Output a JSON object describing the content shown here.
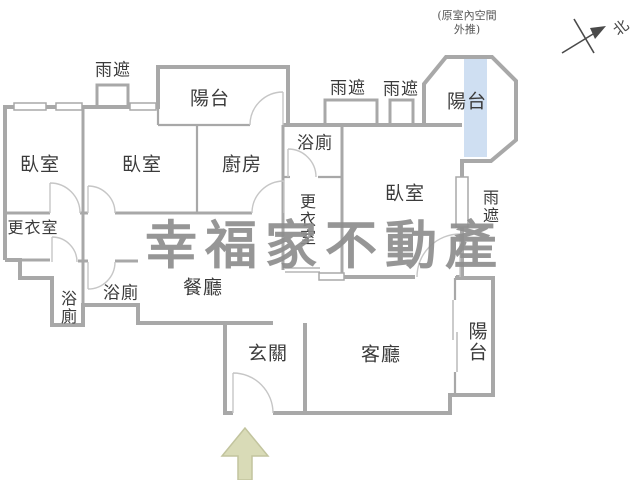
{
  "colors": {
    "wall": "#a8a8a8",
    "door_arc": "#c6c6c6",
    "balcony_highlight": "#cfdff2",
    "arrow_fill": "#d9dbb7",
    "arrow_stroke": "#c2c49e",
    "watermark": "#8e8e8e",
    "label": "#3b3b3b"
  },
  "watermark": {
    "text": "幸福家不動產"
  },
  "compass": {
    "north_label": "北"
  },
  "annotation": {
    "line1": "(原室內空間",
    "line2": "外推)"
  },
  "rooms": {
    "bedroom_left": "臥室",
    "bedroom_middle": "臥室",
    "bedroom_right": "臥室",
    "kitchen": "廚房",
    "balcony_top": "陽台",
    "balcony_octagon": "陽台",
    "balcony_right": "陽台",
    "bath_top": "浴廁",
    "bath_left_small": "浴廁",
    "bath_left_wide": "浴廁",
    "closet_left": "更衣室",
    "closet_right": "更衣室",
    "dining": "餐廳",
    "foyer": "玄關",
    "living": "客廳",
    "canopy_top_left": "雨遮",
    "canopy_mid_left": "雨遮",
    "canopy_mid_right": "雨遮",
    "canopy_right": "雨遮"
  }
}
